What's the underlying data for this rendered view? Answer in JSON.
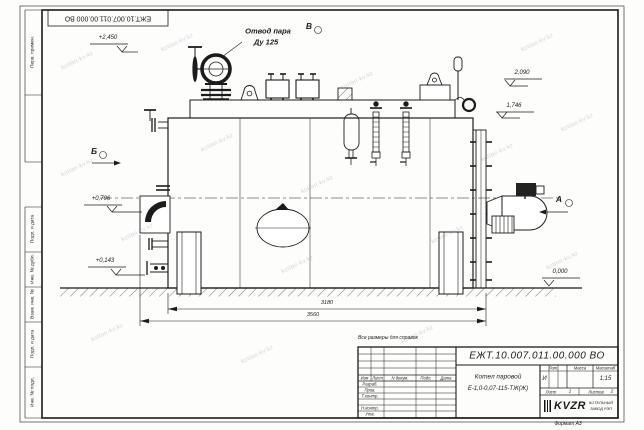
{
  "frame": {
    "top_designation": "ЕЖТ.10.007.011.00.000  ВО",
    "left_strip": {
      "cell1": "Перв. примен.",
      "cell2": "Подп. и дата",
      "cell3": "Инв. № дубл.",
      "cell4": "Взам. инв. №",
      "cell5": "Подп. и дата",
      "cell6": "Инв. № подл."
    },
    "format_note": "Формат А3"
  },
  "watermark": "kotlan-kv.kz",
  "drawing": {
    "callouts": {
      "steam_outlet_l1": "Отвод пара",
      "steam_outlet_l2": "Ду 125"
    },
    "view_labels": {
      "a": "А",
      "b": "Б",
      "v": "В"
    },
    "elevations": {
      "e2450": "+2,450",
      "e2090": "2,090",
      "e1746": "1,746",
      "e0796": "+0,796",
      "e0143": "+0,143",
      "e0000": "0,000"
    },
    "dimensions": {
      "d1": "3180",
      "d2": "3560"
    },
    "reference_note": "Все размеры для справок"
  },
  "title_block": {
    "designation": "ЕЖТ.10.007.011.00.000  ВО",
    "product_name_l1": "Котел паровой",
    "product_name_l2": "Е-1,0-0,07-115-ТЖ(Ж)",
    "col_headers": {
      "izm": "Изм",
      "list": "Лист",
      "n_dokum": "N докум.",
      "podp": "Подп.",
      "data": "Дата"
    },
    "rows": {
      "razrab": "Разраб.",
      "prov": "Пров.",
      "tkontr": "Т.контр.",
      "nkontr": "Н.контр.",
      "utv": "Утв."
    },
    "lit_header": "Лит.",
    "massa_header": "Масса",
    "masshtab_header": "Масштаб",
    "lit_value": "И",
    "scale_value": "1:15",
    "sheet_label": "Лист",
    "sheet_value": "1",
    "sheets_label": "Листов",
    "sheets_value": "2",
    "company_logo": "KVZR",
    "company_name_l1": "КОТЕЛЬНЫЙ",
    "company_name_l2": "ЗАВОД РЭП"
  }
}
